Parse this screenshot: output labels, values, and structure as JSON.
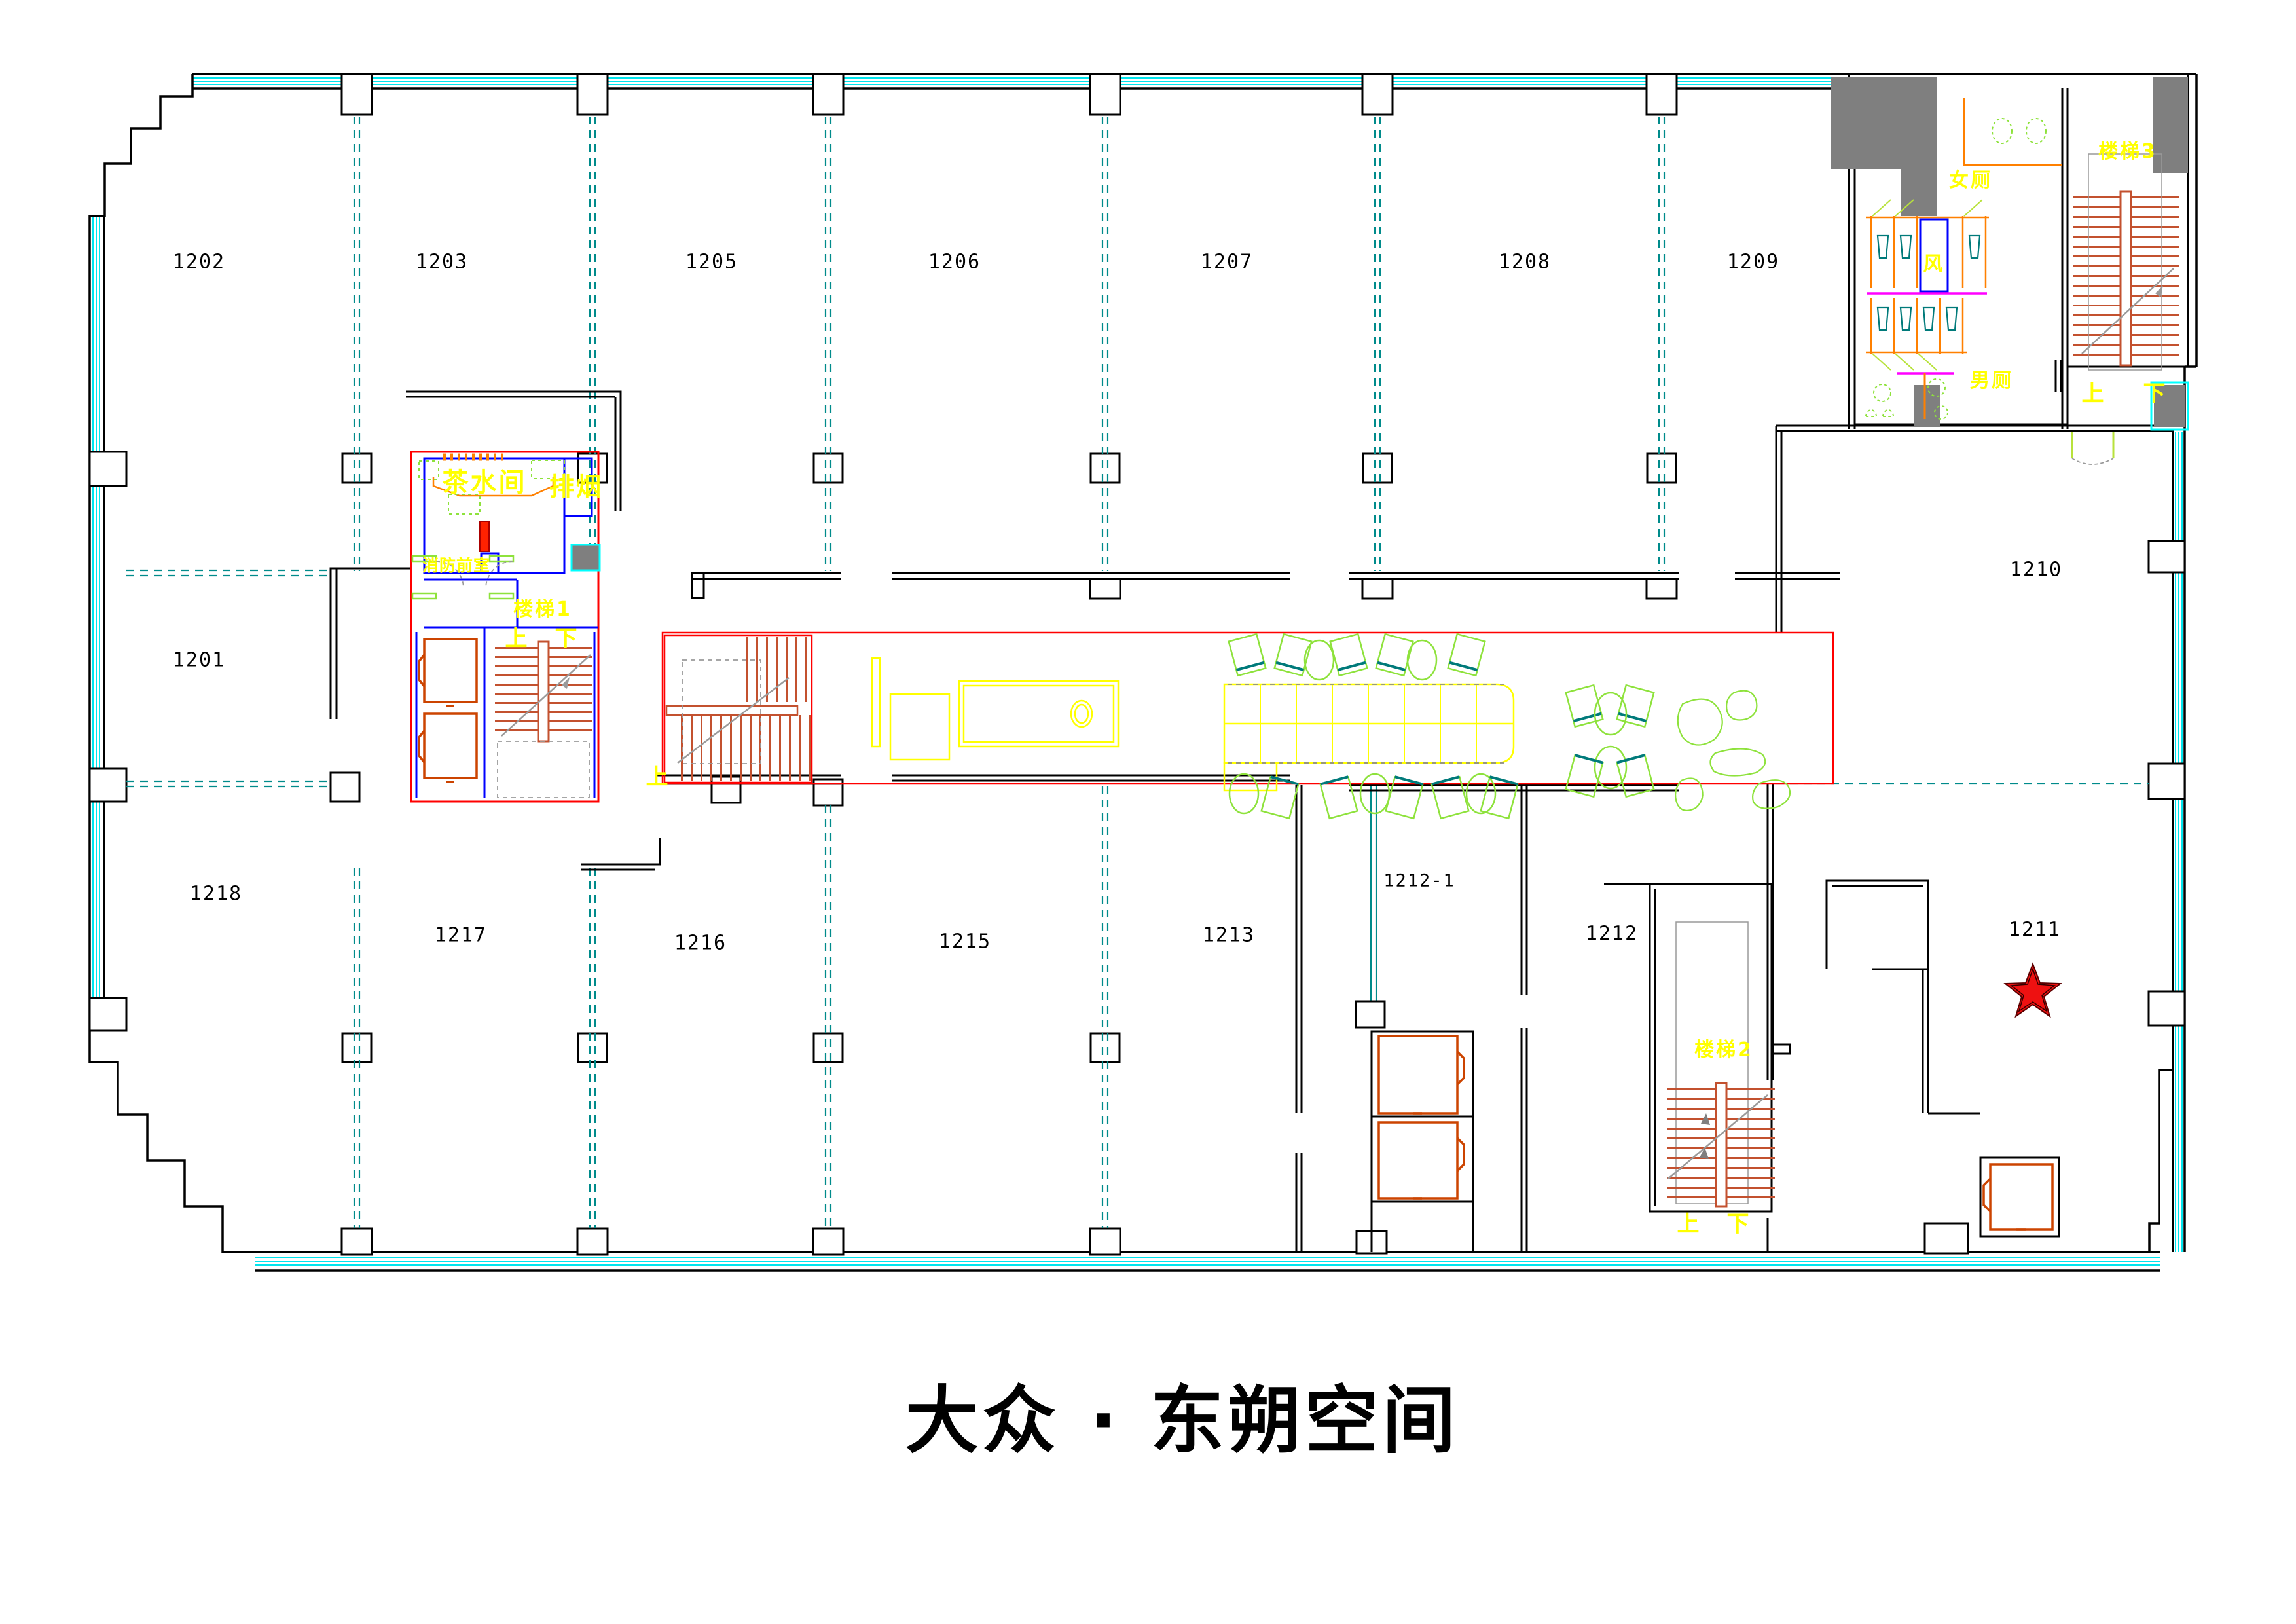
{
  "title": "大众 · 东朔空间",
  "colors": {
    "wall": "#000000",
    "glazing": "#00ffff",
    "grid": "#008b8b",
    "highlight_red": "#ff0000",
    "stair_tread": "#c3512f",
    "elevator": "#cc4400",
    "partition_orange": "#ff8000",
    "cad_yellow": "#ffff00",
    "core_blue": "#0000ff",
    "furniture_green": "#8ee23c",
    "counter_magenta": "#ff00ff",
    "column_gray": "#7f7f7f",
    "star_fill": "#ee1111"
  },
  "rooms": {
    "r1202": "1202",
    "r1203": "1203",
    "r1205": "1205",
    "r1206": "1206",
    "r1207": "1207",
    "r1208": "1208",
    "r1209": "1209",
    "r1201": "1201",
    "r1210": "1210",
    "r1211": "1211",
    "r1212": "1212",
    "r1212_1": "1212-1",
    "r1213": "1213",
    "r1215": "1215",
    "r1216": "1216",
    "r1217": "1217",
    "r1218": "1218"
  },
  "core": {
    "tea_room": "茶水间",
    "smoke_exhaust": "排烟",
    "fire_lobby": "消防前室",
    "stair1": "楼梯1",
    "up": "上",
    "down": "下"
  },
  "corridor": {
    "up": "上"
  },
  "toilets": {
    "female": "女厕",
    "male": "男厕",
    "air_shaft": "风",
    "stair3": "楼梯3",
    "up": "上",
    "down": "下"
  },
  "stair2": {
    "label": "楼梯2",
    "up": "上",
    "down": "下"
  },
  "star_marker": {
    "room": "1211"
  }
}
